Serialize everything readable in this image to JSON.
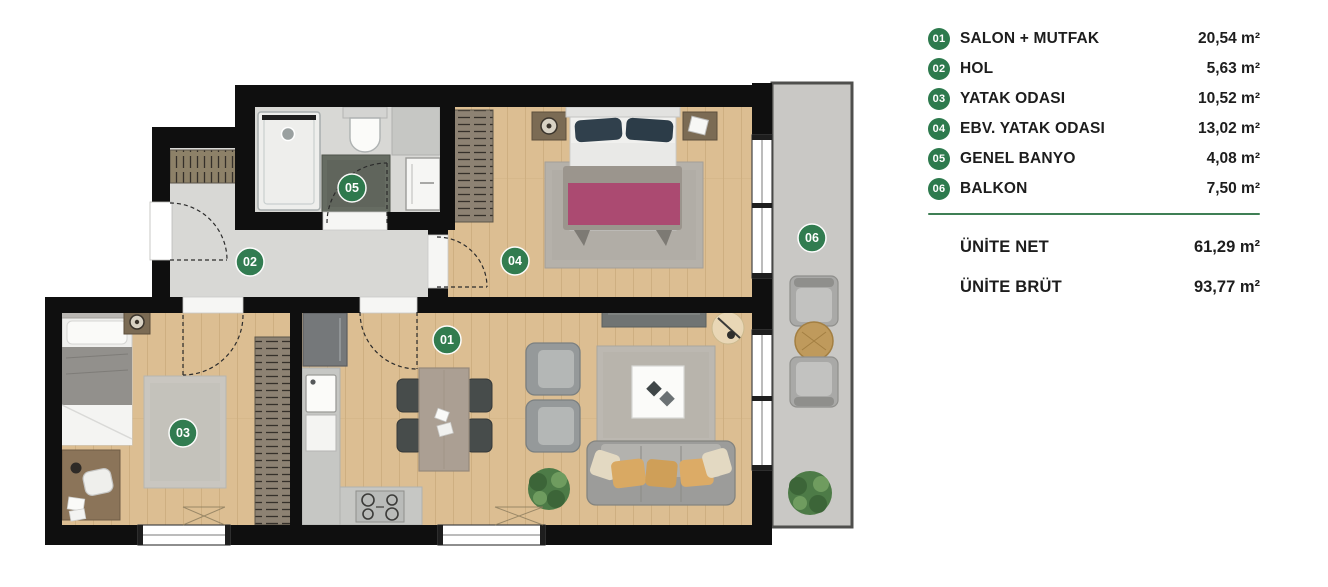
{
  "legend": {
    "rows": [
      {
        "id": "01",
        "label": "SALON + MUTFAK",
        "area": "20,54 m²"
      },
      {
        "id": "02",
        "label": "HOL",
        "area": "5,63 m²"
      },
      {
        "id": "03",
        "label": "YATAK ODASI",
        "area": "10,52 m²"
      },
      {
        "id": "04",
        "label": "EBV. YATAK ODASI",
        "area": "13,02 m²"
      },
      {
        "id": "05",
        "label": "GENEL BANYO",
        "area": "4,08 m²"
      },
      {
        "id": "06",
        "label": "BALKON",
        "area": "7,50 m²"
      }
    ],
    "totals": [
      {
        "label": "ÜNİTE NET",
        "area": "61,29 m²"
      },
      {
        "label": "ÜNİTE BRÜT",
        "area": "93,77 m²"
      }
    ]
  },
  "plan": {
    "badges": [
      {
        "label": "01"
      },
      {
        "label": "02"
      },
      {
        "label": "03"
      },
      {
        "label": "04"
      },
      {
        "label": "05"
      },
      {
        "label": "06"
      }
    ],
    "colors": {
      "wall": "#0f0f0f",
      "wood_floor": "#dcbe92",
      "hall_floor": "#d8d8d5",
      "balcony_floor": "#c9c8c5",
      "badge_green": "#2d7a4d",
      "divider_green": "#3f7f55",
      "accent_pink": "#ab4a71",
      "cushion_tan": "#d9a963",
      "plant_green": "#4d7b47"
    }
  }
}
